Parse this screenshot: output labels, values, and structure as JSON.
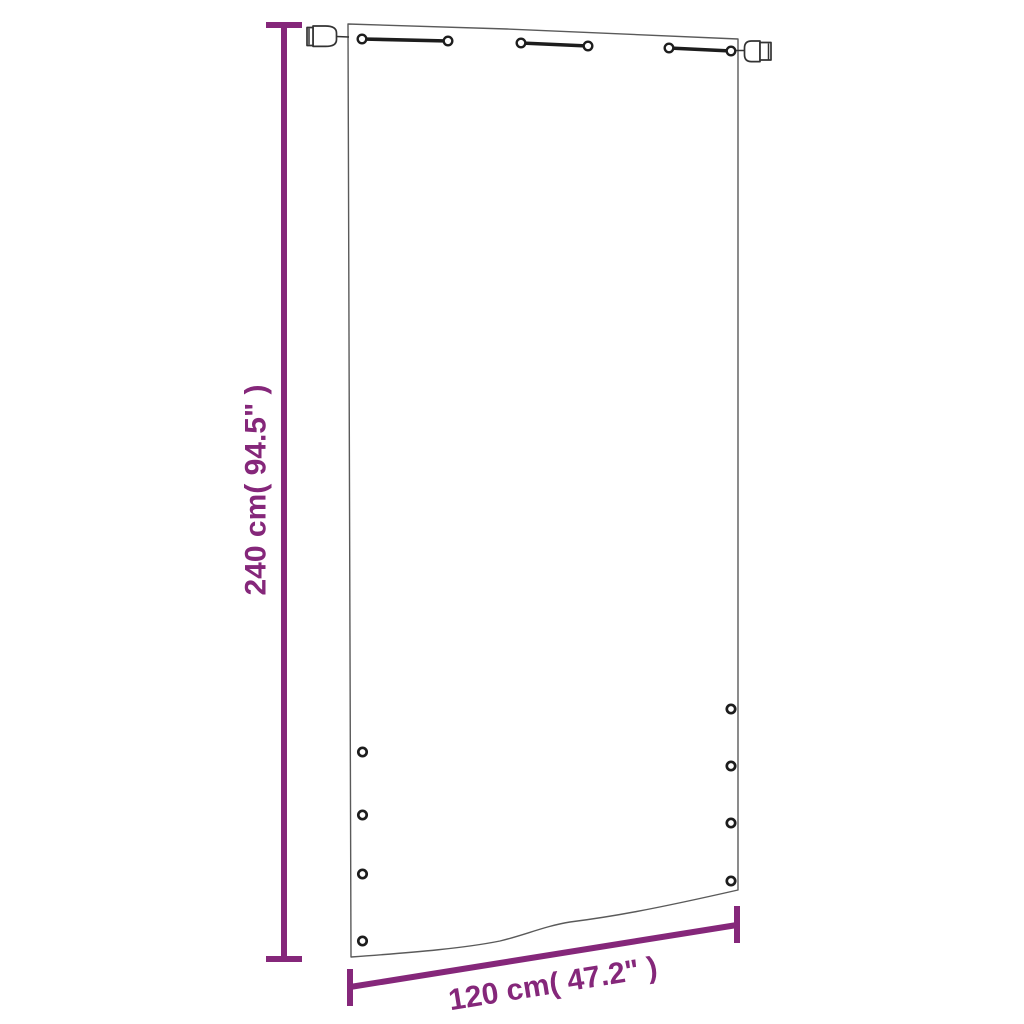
{
  "diagram": {
    "description": "Balcony screen panel with measurements",
    "height_label": "240 cm( 94.5\" )",
    "height_value": "240 cm",
    "height_inches": "94.5\"",
    "width_label": "120 cm( 47.2\" )",
    "width_value": "120 cm",
    "width_inches": "47.2\"",
    "top_tab_count": 3,
    "left_grommet_count": 4,
    "right_grommet_count": 4
  },
  "colors": {
    "accent": "#85277A",
    "outline": "#5a5a5a",
    "hardware": "#1d1d1d",
    "background": "#ffffff"
  }
}
